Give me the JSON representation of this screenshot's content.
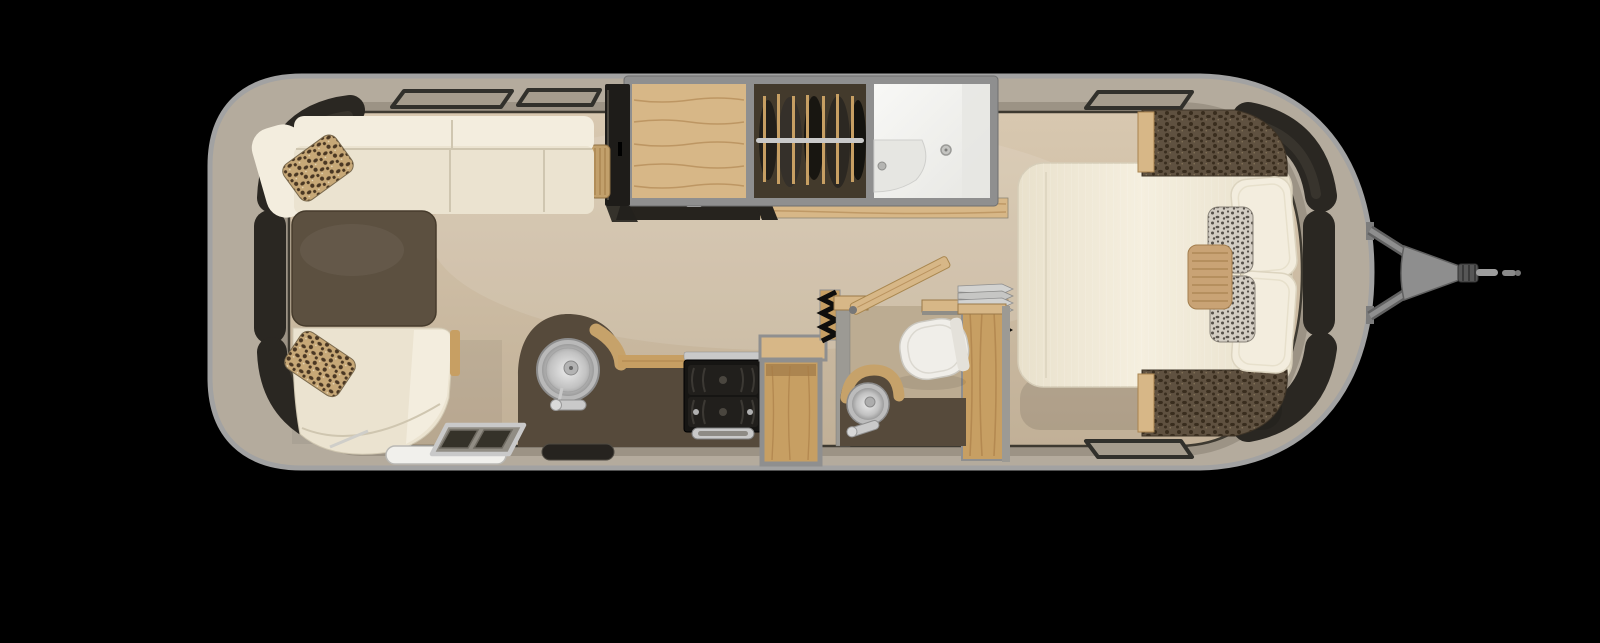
{
  "scene": {
    "type": "floorplan-top-view",
    "subject": "travel-trailer-interior",
    "areas": [
      {
        "name": "dinette-lounge",
        "items": [
          "wraparound-sofa",
          "corner-seat",
          "dinette-table",
          "curved-bench-seat",
          "leopard-accent-pillow",
          "leopard-accent-pillow",
          "wicker-side-table",
          "media-cabinet"
        ]
      },
      {
        "name": "overhead-modules",
        "items": [
          "slide-out-dresser",
          "wardrobe-closet-with-hanging-clothes",
          "closet-rod",
          "shower-stall",
          "shower-bench",
          "shower-drain"
        ]
      },
      {
        "name": "galley",
        "items": [
          "kitchen-counter",
          "round-stainless-sink",
          "faucet",
          "two-burner-stove",
          "oven-handle",
          "open-shelf-cabinet",
          "wood-countertop",
          "floor-vent",
          "wood-floor-strip"
        ]
      },
      {
        "name": "wet-bath",
        "items": [
          "toilet",
          "vanity-counter",
          "round-vanity-sink",
          "vanity-faucet",
          "folding-door-stack",
          "accordion-door-seal",
          "accordion-door-seal",
          "open-wood-door",
          "wardrobe-column",
          "bath-wall"
        ]
      },
      {
        "name": "bedroom",
        "items": [
          "queen-bed",
          "sleeping-pillow",
          "sleeping-pillow",
          "patterned-accent-pillow",
          "patterned-accent-pillow",
          "tan-lumbar-pillow",
          "headboard-corner-cabinet",
          "headboard-corner-cabinet",
          "wood-trim-panel",
          "wood-trim-panel"
        ]
      },
      {
        "name": "shell-and-exterior",
        "items": [
          "aluminum-shell",
          "wraparound-window-band",
          "roof-edge-windows",
          "entry-step",
          "entry-threshold",
          "hitch-a-frame",
          "hitch-coupler",
          "hitch-jack-rod"
        ]
      }
    ]
  },
  "colors": {
    "bg": "#000000",
    "rim": "#a2a2a2",
    "shell": "#b4ab9d",
    "shellInner": "#847c6e",
    "floorTop": "#d8c8b0",
    "floorBottom": "#c1b097",
    "wallLine": "#3e3a31",
    "cream": "#ebe3d0",
    "creamLight": "#f3edde",
    "creamShadow": "#cfc6b0",
    "windowDark": "#2a2722",
    "windowGloss": "#4e493f",
    "windowFrame": "#31302b",
    "bandWindowFill": "#a59c8d",
    "table": "#5c5040",
    "counter": "#564a3b",
    "woodLight": "#d7b787",
    "wood": "#c79f63",
    "woodDark": "#a87c46",
    "woodRim": "#c6a26a",
    "frame": "#8f8f8f",
    "closetDark": "#433a2c",
    "chrome": "#c9c9c9",
    "chromeDark": "#8c8c8c",
    "white": "#f4f4f2",
    "showerShade": "#e6e6e2",
    "wallGray": "#9c9a94",
    "bathFloor": "#bcac92",
    "stove": "#161513",
    "stoveRow": "#211f1c",
    "grate": "#3c3934",
    "vent": "#26231f",
    "toilet": "#f0eee9",
    "hitch": "#8e8e8e",
    "hitchDark": "#616161",
    "steel": "#9d9d9d",
    "inkBlack": "#0f0e0c",
    "leoBase": "#c7a877",
    "leoSpot": "#4a3723",
    "leoFleck": "#e8d9b8",
    "leoDarkBase": "#5f5140",
    "leoDarkSpot": "#392d1e",
    "leoDarkFleck": "#8d7c5e",
    "speckBase": "#d3cdc3",
    "speckSpot": "#56504a",
    "lumbar": "#c9a375",
    "lumbarLine": "#a8824f"
  }
}
